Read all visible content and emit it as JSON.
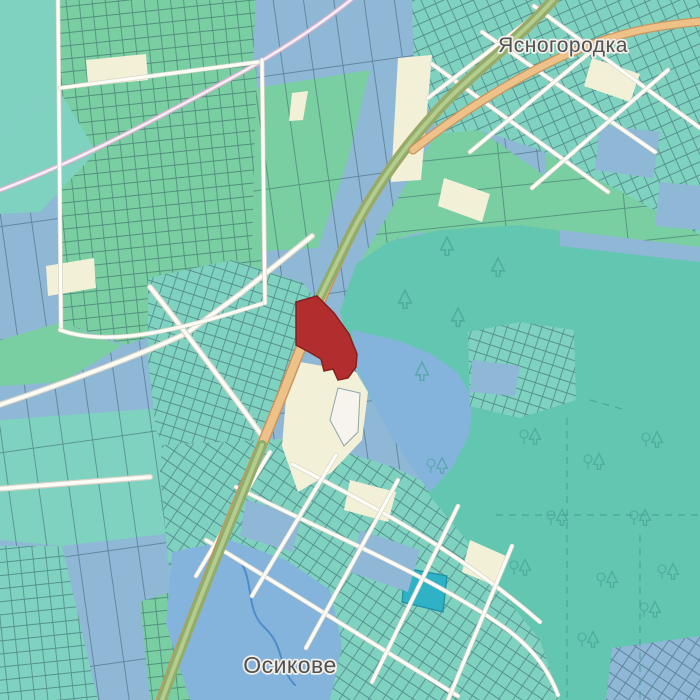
{
  "place_labels": [
    {
      "id": "yasnohorodka",
      "text": "Ясногородка",
      "x": 563,
      "y": 52,
      "size": 21
    },
    {
      "id": "osykove",
      "text": "Осикове",
      "x": 290,
      "y": 673,
      "size": 23
    }
  ],
  "colors": {
    "background": "#f2efe9",
    "field_blue": "#8fb7d6",
    "field_green": "#79cfa2",
    "field_teal": "#7fd2c0",
    "field_cream": "#f3f0d8",
    "forest_teal": "#63c6b0",
    "water_blue": "#84b4dc",
    "stream_blue": "#4f8cc9",
    "pond_cyan": "#2fb2c6",
    "parcel_border": "#2d4f5e",
    "road_orange": "#eec189",
    "road_orange_casing": "#c9955e",
    "road_trunk_green": "#8fae6a",
    "road_trunk_center": "#b6cb8e",
    "road_white": "#fdfcf7",
    "road_white_casing": "#d9d4c6",
    "road_pink_casing": "#d9b3cf",
    "road_pink_fill": "#f6f1f4",
    "selected_parcel": "#b22d2d",
    "selected_parcel_border": "#871f1f",
    "tree_icon": "#3a9a8a",
    "label_color": "#525252"
  },
  "zones": [
    {
      "name": "fields-base",
      "points": "0,0 700,0 700,700 0,700",
      "fill": "field_blue",
      "pattern": "strips"
    },
    {
      "name": "corner-teal-nw",
      "points": "0,0 56,0 58,88 0,132",
      "fill": "field_teal"
    },
    {
      "name": "allot-top-strip",
      "points": "58,0 256,0 253,60 60,88",
      "fill": "field_green",
      "pattern": "grid13"
    },
    {
      "name": "allotments",
      "points": "60,88 256,60 262,300 125,345 62,322",
      "fill": "field_green",
      "pattern": "grid13"
    },
    {
      "name": "green-mid-top",
      "points": "256,88 370,70 348,160 318,248 252,252",
      "fill": "field_green",
      "pattern": "strips"
    },
    {
      "name": "teal-left",
      "points": "0,132 58,88 96,152 40,212 0,214",
      "fill": "field_teal"
    },
    {
      "name": "green-left",
      "points": "0,340 62,322 122,346 62,382 0,386",
      "fill": "field_green"
    },
    {
      "name": "teal-bottom-left",
      "points": "0,420 162,408 236,440 232,526 62,546 0,540",
      "fill": "field_teal",
      "pattern": "strips"
    },
    {
      "name": "teal-bottom-left-2",
      "points": "0,546 62,546 98,700 0,700",
      "fill": "field_teal",
      "pattern": "grid13"
    },
    {
      "name": "green-bottom-mid",
      "points": "140,602 232,572 262,640 246,700 150,700",
      "fill": "field_green",
      "pattern": "grid13"
    },
    {
      "name": "mint-right",
      "points": "548,118 700,106 700,262 560,246 545,176",
      "fill": "field_green",
      "pattern": "strips2"
    },
    {
      "name": "green-east-of-road",
      "points": "436,134 480,130 545,176 560,246 470,248 420,232 388,242 360,262",
      "fill": "field_green",
      "pattern": "strips2"
    },
    {
      "name": "village-north",
      "points": "412,0 700,0 700,235 610,186 540,150 480,130 438,134 414,72",
      "fill": "field_teal",
      "pattern": "gridNE"
    },
    {
      "name": "village-mid",
      "points": "148,278 232,260 302,282 318,302 304,356 280,396 266,442 230,472 178,472 156,430 148,360",
      "fill": "field_teal",
      "pattern": "gridC"
    },
    {
      "name": "village-south",
      "points": "162,445 300,438 396,468 470,505 545,588 568,662 572,700 196,700 168,560 160,470",
      "fill": "field_teal",
      "pattern": "gridA"
    },
    {
      "name": "forest",
      "points": "340,312 356,264 388,242 440,230 520,225 610,238 700,248 700,700 560,700 540,640 498,588 468,542 448,518 430,496 418,468 398,438 370,398 350,350",
      "fill": "forest_teal"
    },
    {
      "name": "forest-bay",
      "points": "352,330 396,340 430,353 458,373 472,398 470,433 452,468 430,492 412,468 390,434 370,396 356,362",
      "fill": "water_blue"
    },
    {
      "name": "forest-grid",
      "points": "468,332 520,322 574,330 576,400 520,418 470,406",
      "fill": "field_teal",
      "pattern": "gridC"
    },
    {
      "name": "pond",
      "points": "172,552 230,540 286,560 330,590 342,645 330,700 190,700 166,624",
      "fill": "water_blue"
    },
    {
      "name": "corner-grid-se",
      "points": "612,648 700,636 700,700 606,700",
      "fill": "field_blue",
      "pattern": "gridA"
    },
    {
      "name": "parcel-cyan",
      "points": "405,568 447,576 443,612 402,602",
      "fill": "pond_cyan",
      "stroke": "#1d8fa3"
    }
  ],
  "patches": [
    {
      "name": "cream-strip-1",
      "points": "86,60 146,54 148,80 88,86",
      "fill": "field_cream"
    },
    {
      "name": "cream-strip-2",
      "points": "46,266 94,258 96,288 48,296",
      "fill": "field_cream"
    },
    {
      "name": "cream-strip-3",
      "points": "398,58 432,55 421,180 391,182",
      "fill": "field_cream"
    },
    {
      "name": "cream-strip-4",
      "points": "292,93 308,91 303,120 289,121",
      "fill": "field_cream"
    },
    {
      "name": "blue-right-1",
      "points": "600,125 660,132 653,178 595,170",
      "fill": "field_blue"
    },
    {
      "name": "blue-right-2",
      "points": "660,182 700,186 700,230 655,226",
      "fill": "field_blue"
    },
    {
      "name": "blue-row-forest-top",
      "points": "560,230 700,247 700,262 560,246",
      "fill": "field_blue"
    },
    {
      "name": "blue-in-forest-grid",
      "points": "472,360 520,366 515,396 470,392",
      "fill": "field_blue"
    },
    {
      "name": "cream-village-s1",
      "points": "350,480 396,492 388,522 344,510",
      "fill": "field_cream"
    },
    {
      "name": "cream-village-s2",
      "points": "470,540 506,556 496,586 462,572",
      "fill": "field_cream"
    },
    {
      "name": "cream-village-n1",
      "points": "592,58 640,74 630,102 584,86",
      "fill": "field_cream"
    },
    {
      "name": "cream-village-n2",
      "points": "444,178 490,194 482,222 438,206",
      "fill": "field_cream"
    },
    {
      "name": "blue-village-s1",
      "points": "360,530 420,550 408,592 350,572",
      "fill": "field_blue"
    },
    {
      "name": "blue-village-s2",
      "points": "246,500 302,516 292,552 240,536",
      "fill": "field_blue"
    },
    {
      "name": "cream-near-red",
      "points": "300,362 356,372 368,392 362,440 332,472 298,492 282,446 286,398",
      "fill": "field_cream"
    },
    {
      "name": "white-parcel",
      "points": "338,388 360,393 358,432 344,446 330,420",
      "fill": "#f6f4ec",
      "stroke": "#8fa6ae"
    }
  ],
  "forest_dashes": [
    {
      "d": "M567,418 L567,700"
    },
    {
      "d": "M496,515 L700,515"
    },
    {
      "d": "M640,535 L640,700"
    },
    {
      "d": "M590,400 L622,409"
    }
  ],
  "trees": {
    "conifers": [
      [
        405,
        300
      ],
      [
        458,
        318
      ],
      [
        422,
        372
      ],
      [
        447,
        247
      ],
      [
        498,
        268
      ]
    ],
    "mixed": [
      [
        530,
        437
      ],
      [
        652,
        440
      ],
      [
        594,
        462
      ],
      [
        557,
        518
      ],
      [
        640,
        518
      ],
      [
        520,
        568
      ],
      [
        607,
        580
      ],
      [
        668,
        572
      ],
      [
        588,
        640
      ],
      [
        650,
        610
      ],
      [
        437,
        466
      ]
    ]
  },
  "stream": {
    "d": "M240,560 C255,585 245,610 265,628 C285,647 278,668 295,685"
  },
  "roads": {
    "pink": {
      "d": "M-5,192 C60,168 120,138 185,103 C240,74 300,42 358,-6"
    },
    "white_field": [
      {
        "name": "track-sw",
        "d": "M312,236 L240,294 L187,333 C140,355 60,385 -4,406"
      },
      {
        "name": "track-mid",
        "d": "M150,287 C178,322 212,368 236,400 C248,416 258,430 266,442"
      },
      {
        "name": "track-west",
        "d": "M-4,489 L150,477"
      }
    ],
    "streets": [
      {
        "d": "M236,487 C320,530 430,575 505,628 C530,646 548,668 558,695"
      },
      {
        "d": "M292,464 C370,505 455,548 540,622"
      },
      {
        "d": "M206,540 C290,592 375,644 458,696"
      },
      {
        "d": "M336,455 L252,596"
      },
      {
        "d": "M398,480 L306,648"
      },
      {
        "d": "M458,506 L372,682"
      },
      {
        "d": "M512,546 L448,700"
      },
      {
        "d": "M270,452 L196,576"
      },
      {
        "d": "M432,64 L608,192"
      },
      {
        "d": "M482,32 L655,152"
      },
      {
        "d": "M534,6 L700,128"
      },
      {
        "d": "M470,152 L612,34"
      },
      {
        "d": "M532,188 L668,70"
      },
      {
        "d": "M428,98 L540,12"
      },
      {
        "d": "M58,0 L61,330"
      },
      {
        "d": "M60,330 C110,348 180,330 264,303"
      },
      {
        "d": "M262,60 L265,303"
      },
      {
        "d": "M60,88 L258,62"
      }
    ],
    "trunk": {
      "d": "M558,-6 C520,40 462,80 431,118 C400,152 370,196 350,236 C330,276 312,320 296,360 C281,399 260,450 240,497 C220,545 196,610 176,660 L160,704"
    },
    "trunk_green_segments": [
      {
        "d": "M558,-6 C520,40 462,80 431,118 C400,152 370,196 350,236 C336,264 324,288 314,310"
      },
      {
        "d": "M262,445 C244,490 220,548 198,604 C188,630 172,672 162,700"
      }
    ],
    "secondary_orange": {
      "d": "M413,150 C455,116 520,74 575,51 C625,30 662,25 705,21"
    }
  },
  "selected_parcel": {
    "points": "296,302 317,296 334,313 349,334 357,354 356,367 348,378 338,380 333,369 324,371 321,359 309,352 296,345"
  }
}
